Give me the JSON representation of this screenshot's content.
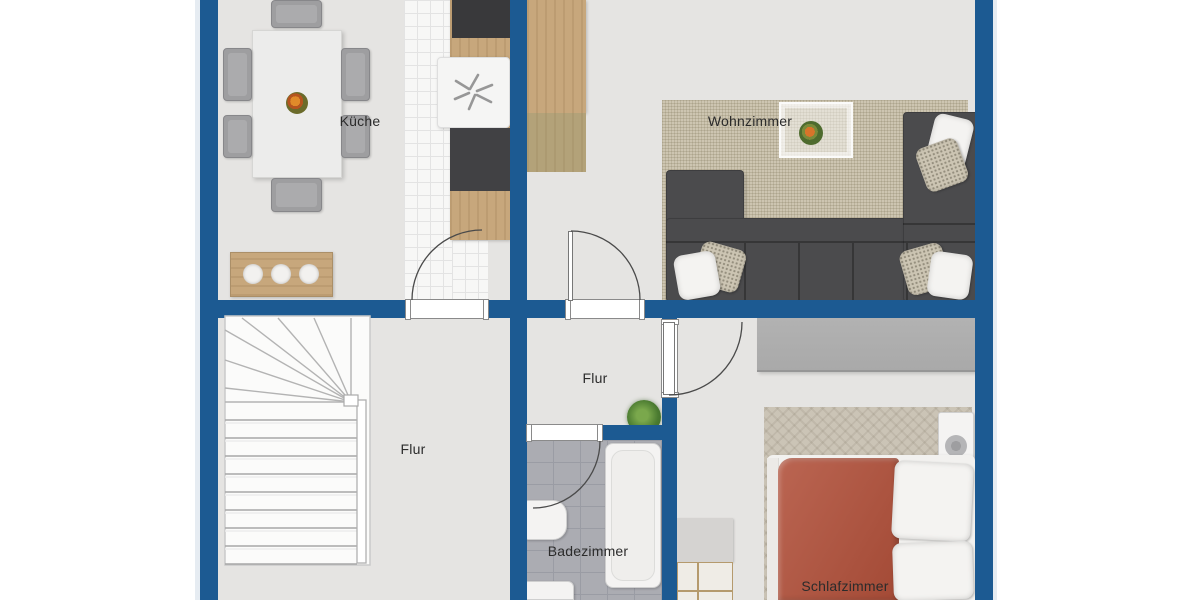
{
  "plan_type": "apartment-floor-plan",
  "rooms": {
    "kitchen": {
      "label": "Küche"
    },
    "living": {
      "label": "Wohnzimmer"
    },
    "hall_large": {
      "label": "Flur"
    },
    "hall_small": {
      "label": "Flur"
    },
    "bath": {
      "label": "Badezimmer"
    },
    "bedroom": {
      "label": "Schlafzimmer"
    }
  },
  "icons": {
    "stove_fan": "✻"
  },
  "colors": {
    "background": "#ffffff",
    "wall": "#1c5a92",
    "floor": "#e5e4e2",
    "tile_white": "#f7f7f6",
    "bath_tile": "#abacb2",
    "bath_grout": "#9a9ca4",
    "wood": "#c7a77c",
    "wood_dark": "#b3a279",
    "rug_living": "#cdc5b1",
    "rug_bedroom": "#cbc4b6",
    "sofa": "#4b4b4d",
    "duvet": "#b1503a",
    "wardrobe": "#a9a9a9",
    "chair": "#9e9ea0",
    "fixture_white": "#f4f3f2",
    "label_text": "#2b2b2b"
  }
}
